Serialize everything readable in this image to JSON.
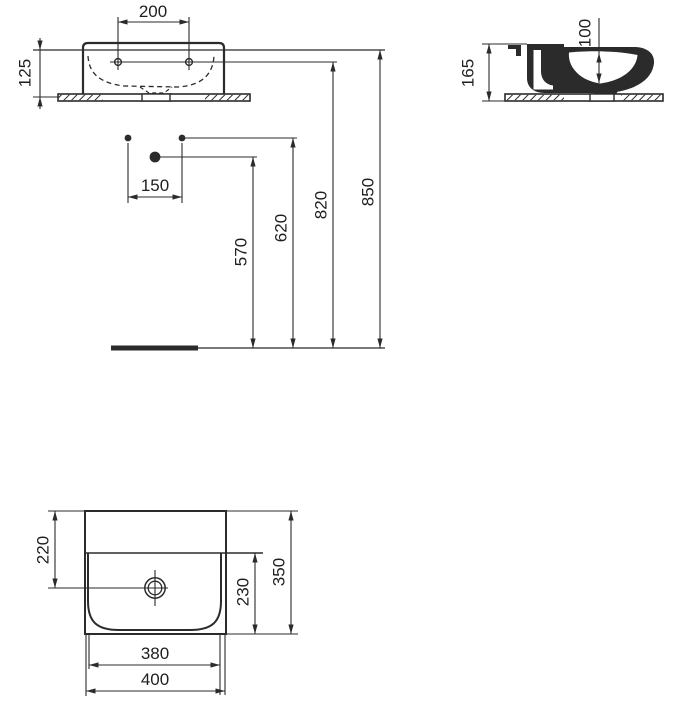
{
  "drawing": {
    "line_color": "#2b2b2b",
    "background": "#ffffff"
  },
  "front": {
    "d200": "200",
    "d125": "125",
    "d150": "150",
    "d570": "570",
    "d620": "620",
    "d820": "820",
    "d850": "850"
  },
  "side": {
    "d165": "165",
    "d100": "100"
  },
  "plan": {
    "d220": "220",
    "d230": "230",
    "d350": "350",
    "d380": "380",
    "d400": "400"
  }
}
